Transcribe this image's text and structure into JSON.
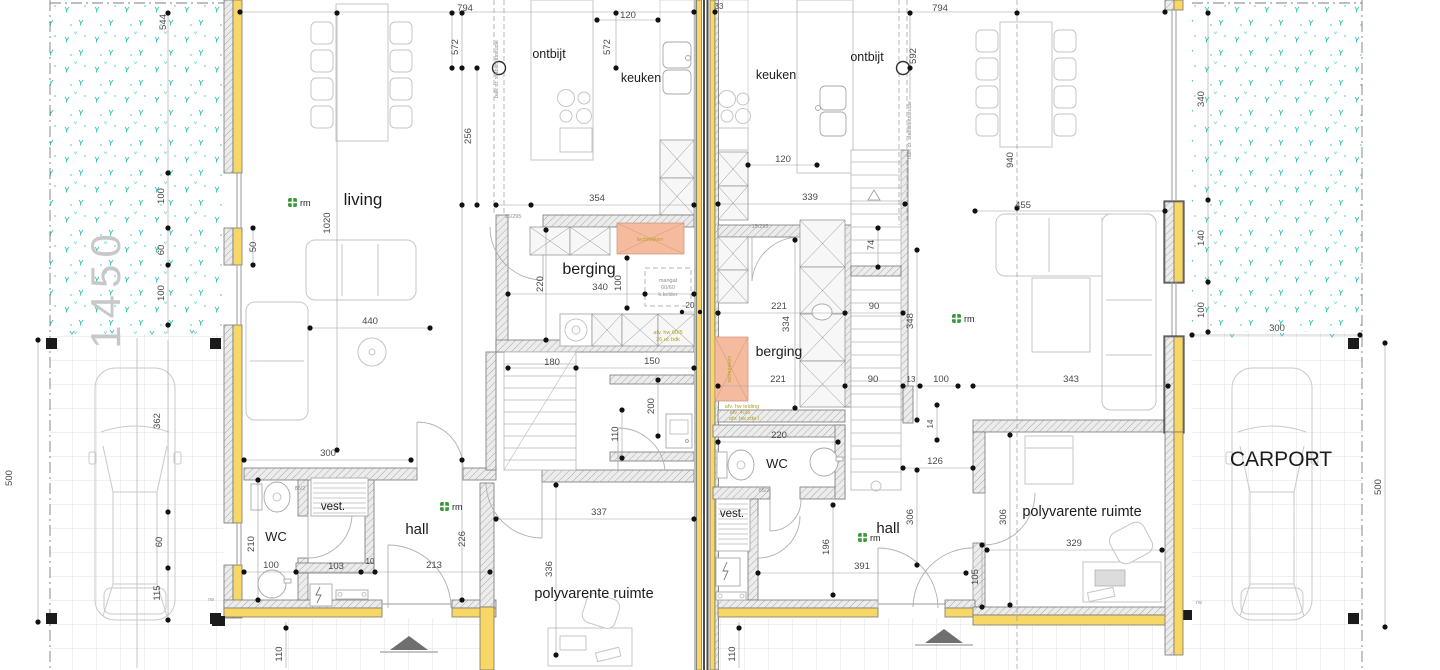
{
  "site": {
    "boundary_width_label": "1450",
    "left_depth": "500",
    "right_depth": "500",
    "carport": "CARPORT"
  },
  "rooms": {
    "living_l": "living",
    "ontbijt_l": "ontbijt",
    "keuken_l": "keuken",
    "berging_l": "berging",
    "wc_l": "WC",
    "vest_l": "vest.",
    "hall_l": "hall",
    "poly_l": "polyvarente ruimte",
    "keuken_r": "keuken",
    "ontbijt_r": "ontbijt",
    "berging_r": "berging",
    "wc_r": "WC",
    "vest_r": "vest.",
    "hall_r": "hall",
    "poly_r": "polyvarente ruimte"
  },
  "icons": {
    "smoke_detector": "rm"
  },
  "annotations": {
    "beam_left": "balk dr. stabiliteitsstudie",
    "beam_right": "balk dr. stabiliteitsstudie",
    "manhole_1": "mangat",
    "manhole_2": "60/60",
    "manhole_3": "k.kelder",
    "tech_left": "technieken",
    "tech_right": "technieken",
    "drain_l1": "afv. hw 60/5",
    "drain_l2": "26 uc bdk",
    "drain_r1": "afv. hw leiding",
    "drain_r2": "afv. 40/5",
    "drain_r3": "afv. hw cde.l",
    "lintel_left": "15/295",
    "lintel_right": "15/295",
    "sill_left": "85/2",
    "sill_right": "85/2",
    "rw_left": "rw",
    "rw_right": "rw"
  },
  "dims": {
    "d1": "794",
    "d2": "794",
    "d3": "33",
    "d4": "544",
    "d5": "572",
    "d6": "572",
    "d7": "120",
    "d8": "256",
    "d9": "592",
    "d10": "120",
    "d11": "354",
    "d12": "339",
    "d13": "940",
    "d14": "455",
    "d15": "1020",
    "d16": "100",
    "d17": "60",
    "d18": "100",
    "d19": "50",
    "d20": "440",
    "d21": "300",
    "d22": "220",
    "d23": "340",
    "d24": "100",
    "d25": "20",
    "d26": "180",
    "d27": "150",
    "d28": "200",
    "d29": "110",
    "d30": "210",
    "d31": "100",
    "d32": "103",
    "d33": "10",
    "d34": "213",
    "d35": "226",
    "d36": "110",
    "d37": "337",
    "d38": "336",
    "d39": "362",
    "d40": "60",
    "d41": "115",
    "d42": "500",
    "d43": "221",
    "d44": "334",
    "d45": "221",
    "d46": "74",
    "d47": "90",
    "d48": "90",
    "d49": "348",
    "d50": "13",
    "d51": "100",
    "d52": "14",
    "d53": "220",
    "d54": "126",
    "d55": "306",
    "d56": "196",
    "d57": "391",
    "d58": "110",
    "d59": "306",
    "d60": "329",
    "d61": "105",
    "d62": "343",
    "d63": "340",
    "d64": "140",
    "d65": "100",
    "d66": "300",
    "d67": "500"
  },
  "colors": {
    "insulation_yellow": "#f7d766",
    "grass_teal": "#35c3b0",
    "technical_orange": "#f5bb9e",
    "smoke_detector_green": "#3a9a3a"
  }
}
